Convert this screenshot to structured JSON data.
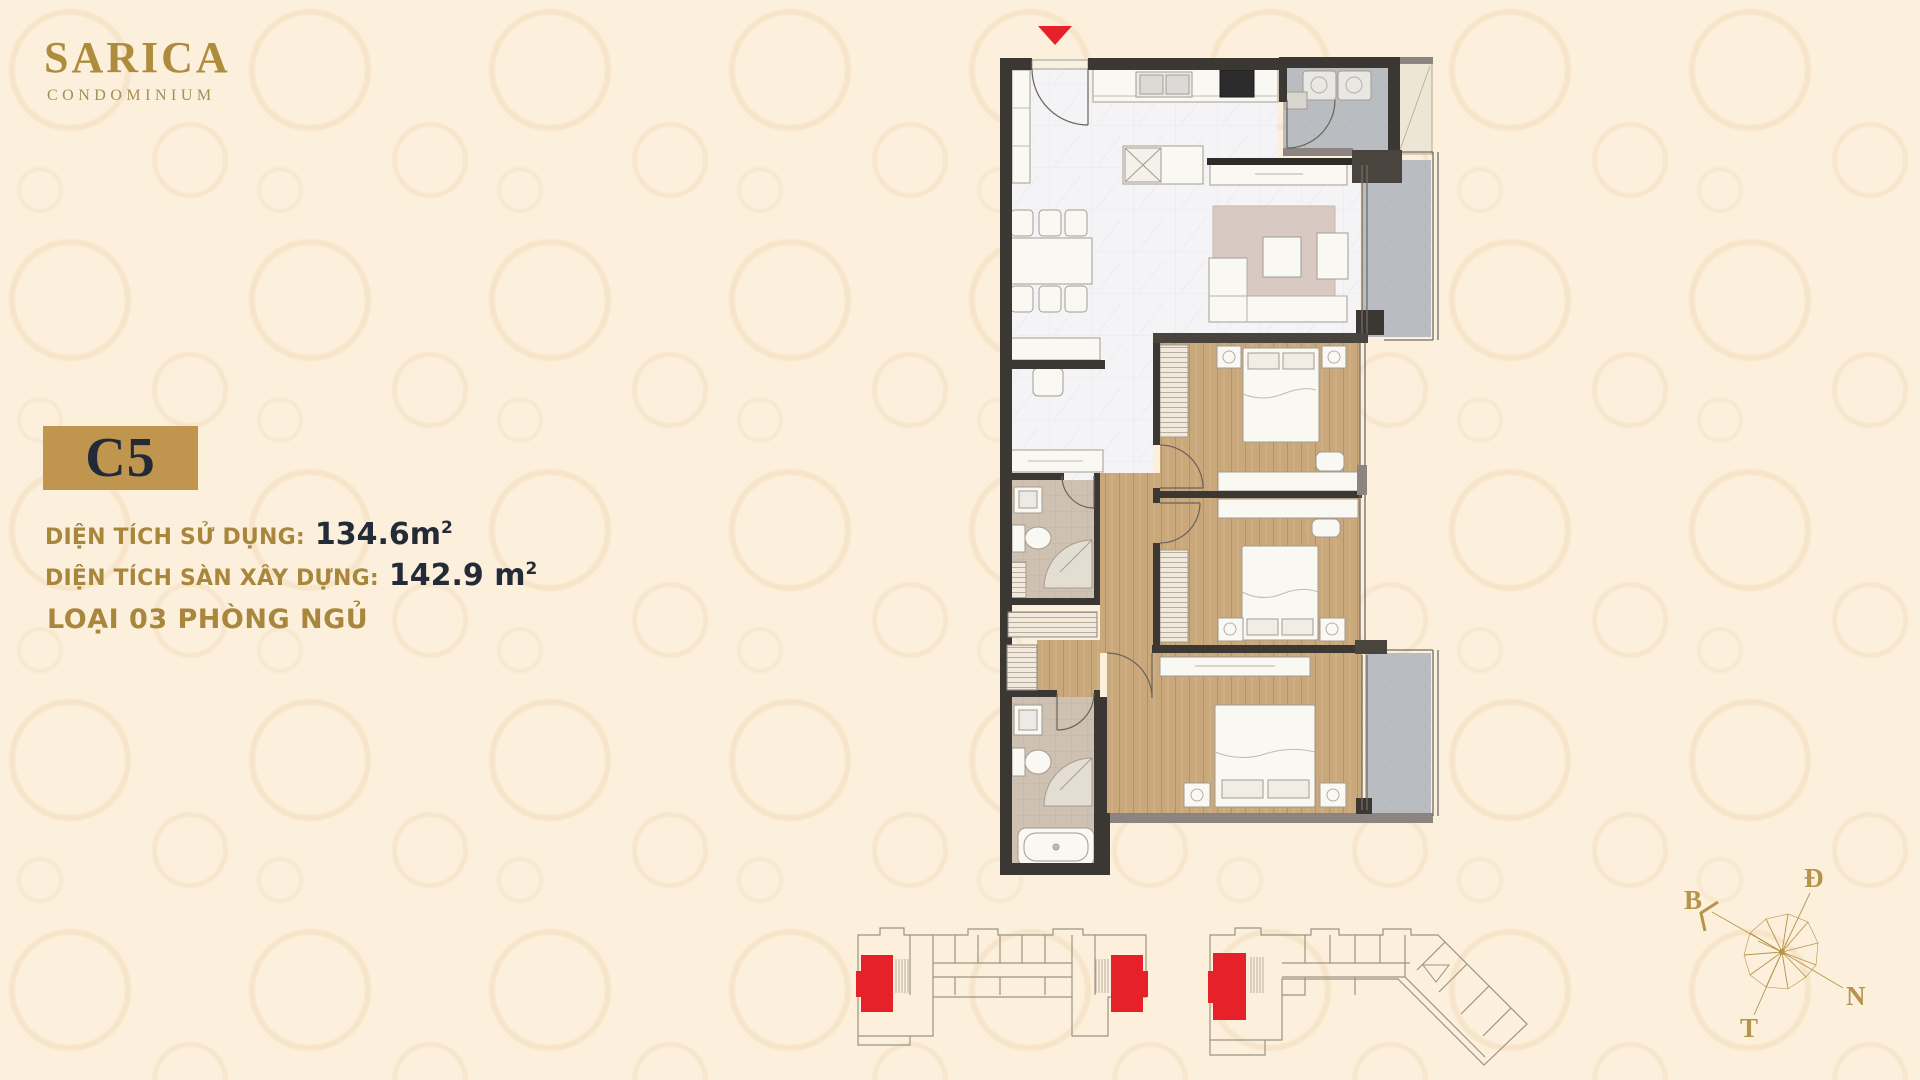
{
  "brand": {
    "name": "SARICA",
    "tagline": "CONDOMINIUM"
  },
  "unit": {
    "code": "C5",
    "area_use_label": "DIỆN TÍCH SỬ DỤNG:",
    "area_use_value": "134.6",
    "area_use_unit": "m",
    "area_use_sup": "2",
    "area_built_label": "DIỆN TÍCH SÀN XÂY DỰNG:",
    "area_built_value": "142.9",
    "area_built_unit": " m",
    "area_built_sup": "2",
    "type_label": "LOẠI 03 PHÒNG NGỦ"
  },
  "compass": {
    "east": "Đ",
    "north": "B",
    "south": "N",
    "west": "T"
  },
  "colors": {
    "background": "#fcefdc",
    "gold_text": "#a8873d",
    "brand_gold": "#ae8c3e",
    "navy_text": "#242b38",
    "unit_box_gold": "#c0964f",
    "highlight_red": "#e62129",
    "wall_dark": "#3b3733",
    "wall_gray": "#8b8480",
    "wood_floor": "#c9a87c",
    "marble_floor": "#f4f4f6",
    "balcony_floor": "#b9bdc2",
    "bathroom_tile": "#cfc1b2",
    "rug": "#d8cac2",
    "compass_gold": "#b6954a"
  }
}
